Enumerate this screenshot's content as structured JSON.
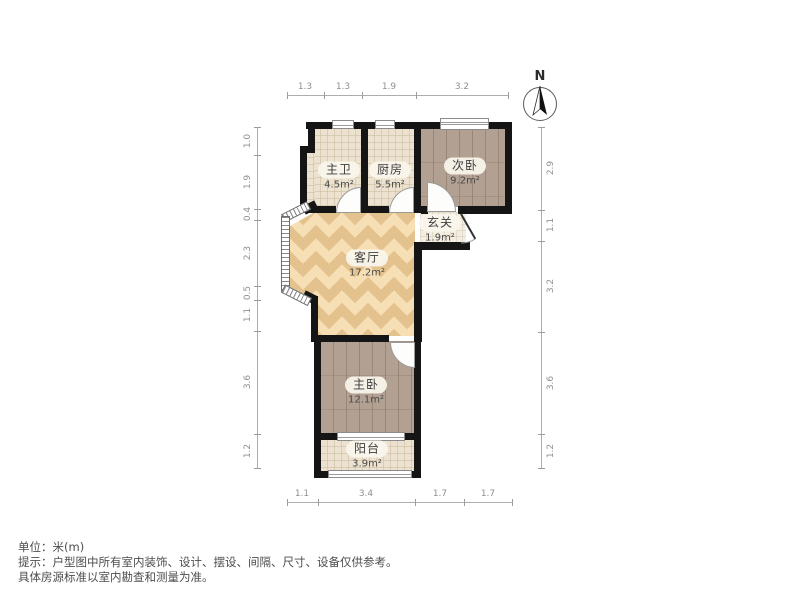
{
  "title": "户型图",
  "compass": {
    "label": "N"
  },
  "rooms": [
    {
      "id": "master-bath",
      "name": "主卫",
      "area": "4.5m²"
    },
    {
      "id": "kitchen",
      "name": "厨房",
      "area": "5.5m²"
    },
    {
      "id": "bedroom-second",
      "name": "次卧",
      "area": "9.2m²"
    },
    {
      "id": "hallway",
      "name": "玄关",
      "area": "1.9m²"
    },
    {
      "id": "living-room",
      "name": "客厅",
      "area": "17.2m²"
    },
    {
      "id": "master-bedroom",
      "name": "主卧",
      "area": "12.1m²"
    },
    {
      "id": "balcony",
      "name": "阳台",
      "area": "3.9m²"
    }
  ],
  "dimensions": {
    "top": [
      "1.3",
      "1.3",
      "1.9",
      "3.2"
    ],
    "bottom": [
      "1.1",
      "3.4",
      "1.7",
      "1.7"
    ],
    "left": [
      "1.0",
      "1.9",
      "0.4",
      "2.3",
      "0.5",
      "1.1",
      "3.6",
      "1.2"
    ],
    "right": [
      "2.9",
      "1.1",
      "3.2",
      "3.6",
      "1.2"
    ]
  },
  "footer": {
    "unit": "单位：米(m)",
    "tip1": "提示：户型图中所有室内装饰、设计、摆设、间隔、尺寸、设备仅供参考。",
    "tip2": "具体房源标准以室内勘查和测量为准。"
  },
  "colors": {
    "wall": "#151515",
    "wood_floor": "#b2a092",
    "parquet_floor": "#f6dfb4",
    "tile_floor": "#ece2cf",
    "dimension_text": "#8f8f8f"
  }
}
